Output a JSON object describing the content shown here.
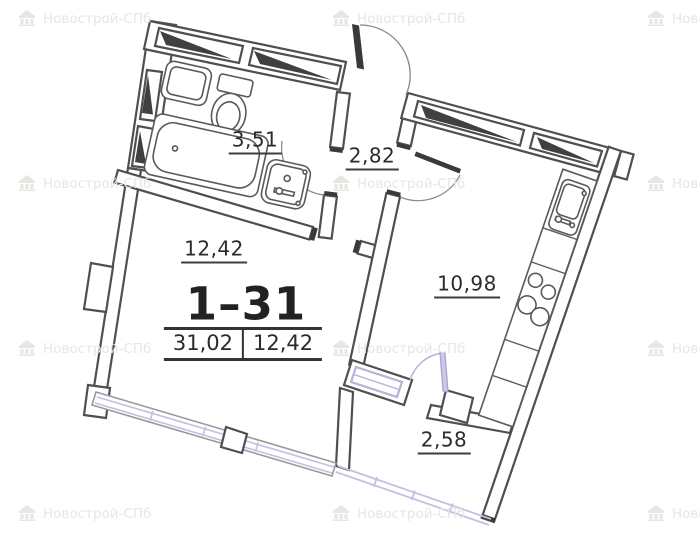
{
  "apartment": {
    "number": "1–31",
    "total_area": "31,02",
    "living_area": "12,42"
  },
  "rooms": [
    {
      "id": "bathroom",
      "area": "3,51"
    },
    {
      "id": "hallway",
      "area": "2,82"
    },
    {
      "id": "living-room",
      "area": "12,42"
    },
    {
      "id": "kitchen",
      "area": "10,98"
    },
    {
      "id": "balcony",
      "area": "2,58"
    }
  ],
  "watermark": {
    "text": "Новострой-СПб"
  },
  "colors": {
    "wall_outline": "#4f4f4f",
    "dark_fill": "#3a3a3a",
    "accent_lavender": "#b7b2d8",
    "label": "#2b2b2b",
    "watermark": "#e7e6e2"
  }
}
